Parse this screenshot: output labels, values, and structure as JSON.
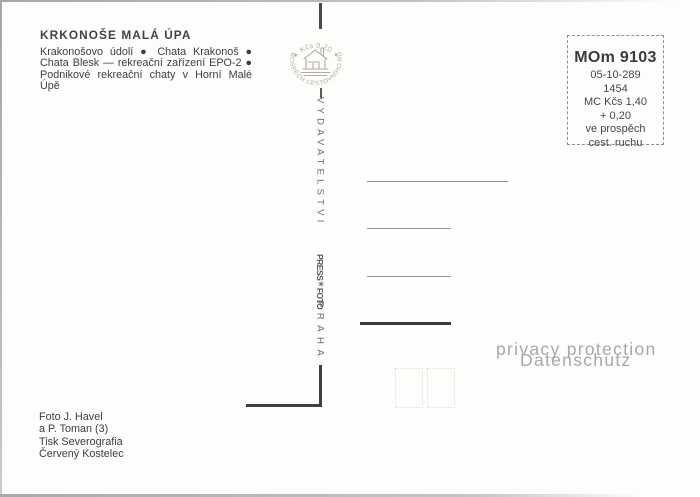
{
  "intro": {
    "title": "KRKONOŠE MALÁ ÚPA",
    "lines": [
      "Krakonošovo údolí ● Chata Krakonoš ●",
      "Chata Blesk — rekreační zařízení EPO-2 ●",
      "Podnikové rekreační chaty v Horní Malé Úpě"
    ]
  },
  "stamp": {
    "value_text": "✶ Kčs 0,20 ✶",
    "ring_text": "VE PROSPĚCH CESTOVNÍHO RUCHU"
  },
  "spine": {
    "publisher": "VYDAVATELSTVI",
    "press": "PRESS",
    "star": "✳",
    "foto": "FOTO",
    "city": "PRAHA"
  },
  "codebox": {
    "code": "MOm 9103",
    "lines": [
      "05-10-289",
      "1454",
      "MC Kčs 1,40",
      "+ 0,20",
      "ve prospěch",
      "cest. ruchu"
    ]
  },
  "imprint": {
    "lines": [
      "Foto J. Havel",
      "a P. Toman (3)",
      "Tisk Severografia",
      "Červený Kostelec"
    ]
  },
  "watermark": {
    "line1": "privacy protection",
    "line2": "Datenschutz"
  },
  "colors": {
    "ink": "#3e3e3e",
    "stamp_ink": "#b3aba2",
    "watermark": "#a8a8a8"
  }
}
